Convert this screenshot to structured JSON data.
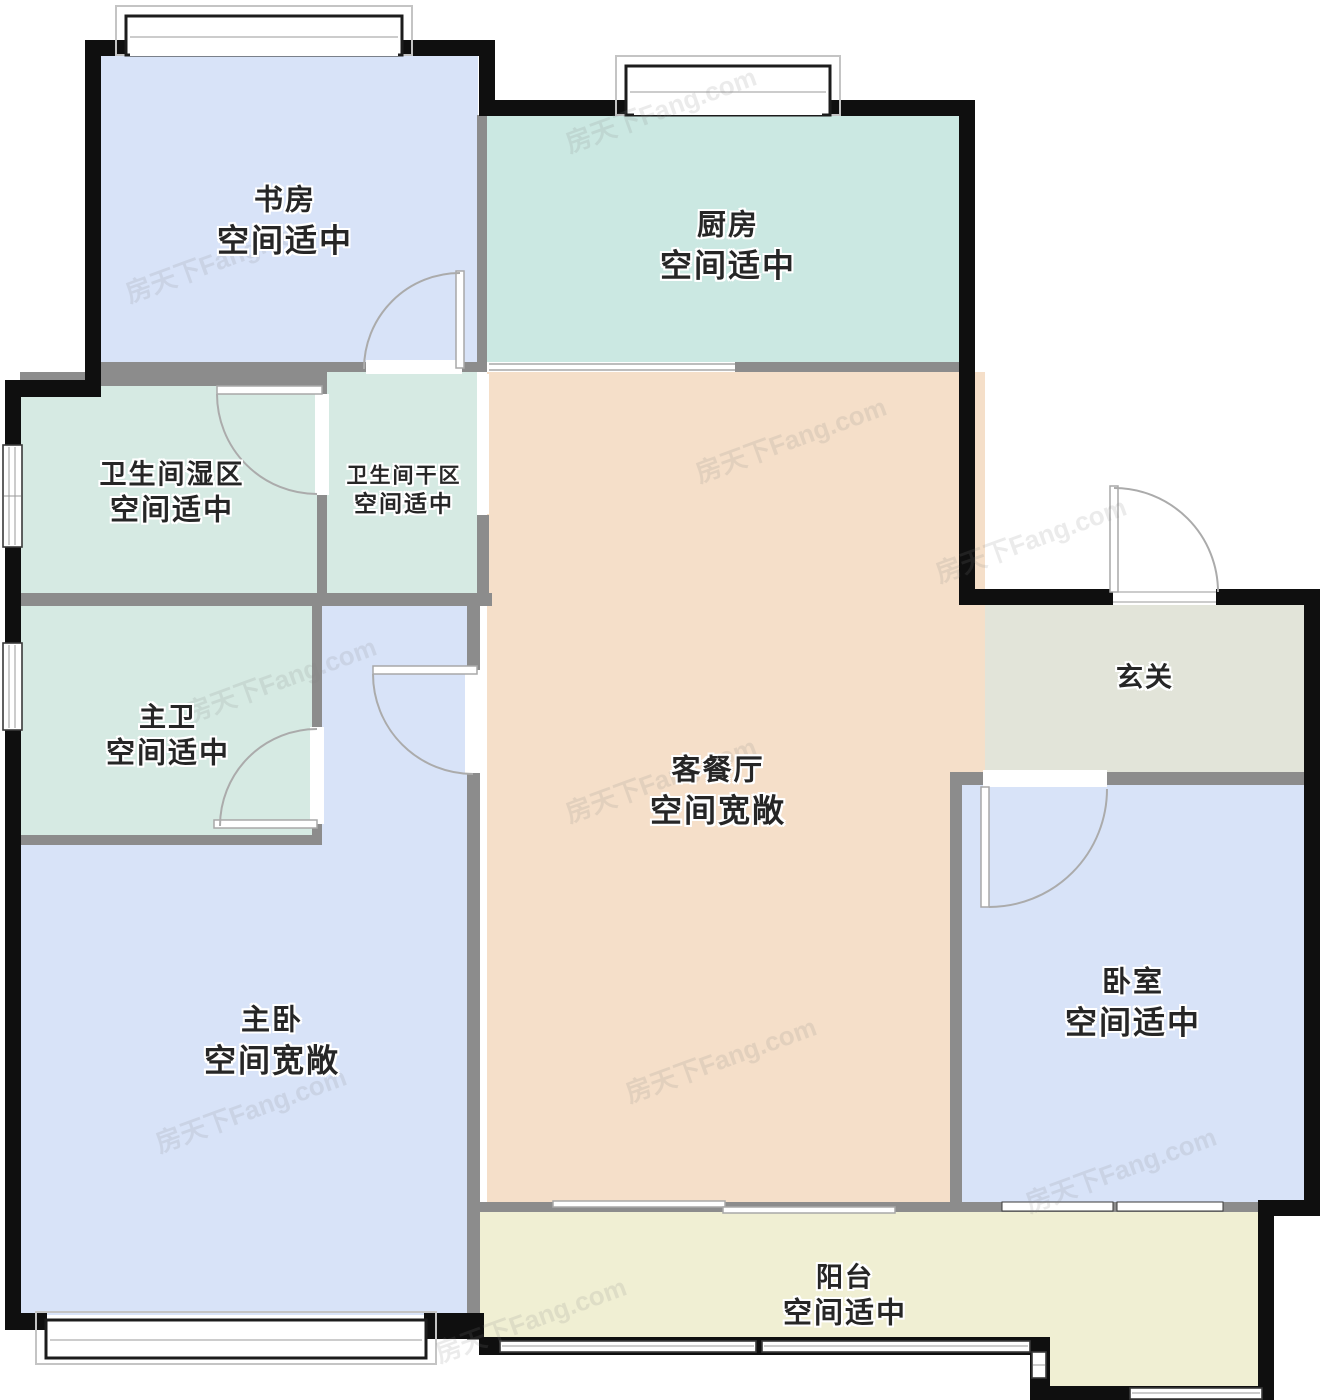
{
  "watermark": "房天下Fang.com",
  "colors": {
    "wall-ext": "#0f0f0f",
    "wall-int": "#8c8c8c",
    "room-blue": "#d8e3f8",
    "room-kitchen": "#cbe8e2",
    "room-bath": "#d6eae3",
    "room-peach": "#f5dfc9",
    "room-entry": "#e2e4d9",
    "room-balcony": "#f0efd3",
    "label-color": "#262626"
  },
  "rooms": {
    "study": {
      "name": "书房",
      "note": "空间适中"
    },
    "kitchen": {
      "name": "厨房",
      "note": "空间适中"
    },
    "bath_wet": {
      "name": "卫生间湿区",
      "note": "空间适中"
    },
    "bath_dry": {
      "name": "卫生间干区",
      "note": "空间适中"
    },
    "master_bath": {
      "name": "主卫",
      "note": "空间适中"
    },
    "entry": {
      "name": "玄关",
      "note": ""
    },
    "living": {
      "name": "客餐厅",
      "note": "空间宽敞"
    },
    "master_bedroom": {
      "name": "主卧",
      "note": "空间宽敞"
    },
    "bedroom": {
      "name": "卧室",
      "note": "空间适中"
    },
    "balcony": {
      "name": "阳台",
      "note": "空间适中"
    }
  }
}
